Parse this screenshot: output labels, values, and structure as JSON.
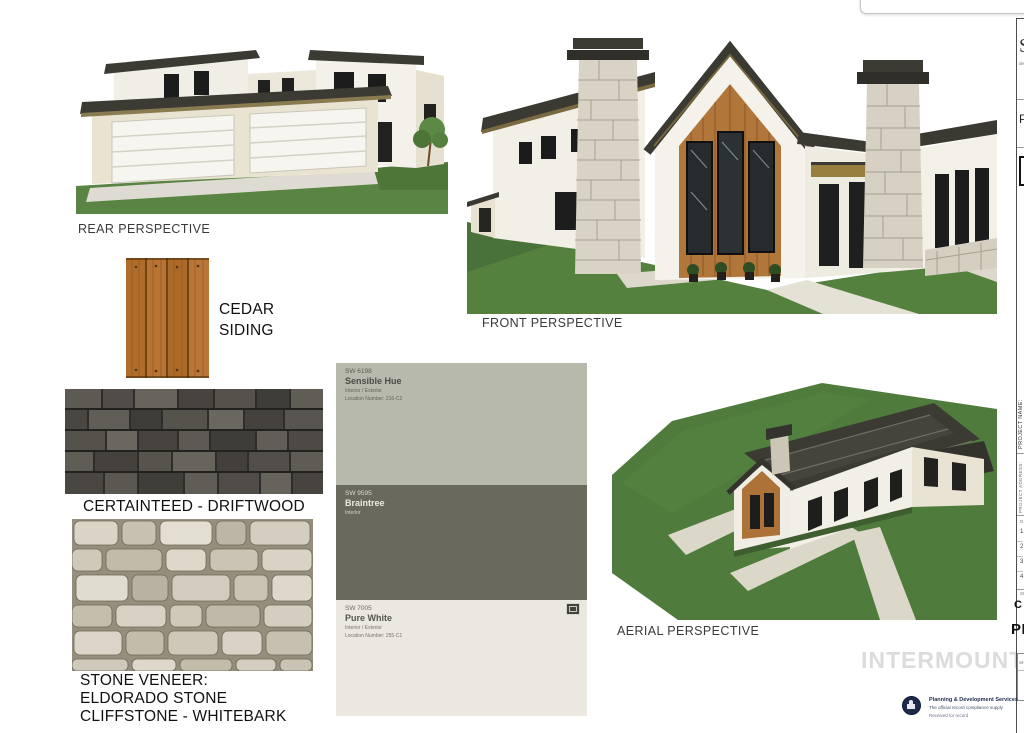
{
  "perspectives": {
    "rear_label": "REAR PERSPECTIVE",
    "front_label": "FRONT PERSPECTIVE",
    "aerial_label": "AERIAL PERSPECTIVE"
  },
  "materials": {
    "cedar_line1": "CEDAR",
    "cedar_line2": "SIDING",
    "shingle_label": "CERTAINTEED - DRIFTWOOD",
    "stone_line1": "STONE VENEER:",
    "stone_line2": "ELDORADO STONE",
    "stone_line3": "CLIFFSTONE - WHITEBARK"
  },
  "paint_swatches": [
    {
      "code": "SW 6198",
      "name": "Sensible Hue",
      "sub1": "Interior / Exterior",
      "sub2": "Location Number: 216-C2",
      "bg": "#b7b9ad",
      "fg": "#4c4c44"
    },
    {
      "code": "SW 9595",
      "name": "Braintree",
      "sub1": "Interior",
      "sub2": "",
      "bg": "#696a5d",
      "fg": "#edebdf"
    },
    {
      "code": "SW 7005",
      "name": "Pure White",
      "sub1": "Interior / Exterior",
      "sub2": "Location Number: 255-C1",
      "bg": "#eae8df",
      "fg": "#57564c"
    }
  ],
  "watermark": "INTERMOUNTAIN",
  "title_block": {
    "letter_s": "S",
    "letter_s_sub": "design",
    "letter_p": "P",
    "project_name_label": "PROJECT NAME:",
    "address_label": "PROJECT ADDRESS:",
    "rev_rows": [
      "1",
      "2",
      "3",
      "4"
    ],
    "rev_header": "D",
    "sheet_note": "SH",
    "sheet_code_line1": "C",
    "sheet_code_line2": "PE",
    "sheet_box_note": "SHEET"
  },
  "stamp": {
    "line1": "Planning & Development Services",
    "line2": "The official record compliance supply",
    "line3": "Received for record"
  },
  "colors": {
    "cedar": "#b17230",
    "shingle": "#4b4843",
    "stone_mortar": "#958e7c",
    "grass": "#55813f",
    "roof": "#3b3a33",
    "wall_cream": "#e9e3d2",
    "wall_white": "#f3f0e8",
    "wood_gable": "#b1763a"
  }
}
